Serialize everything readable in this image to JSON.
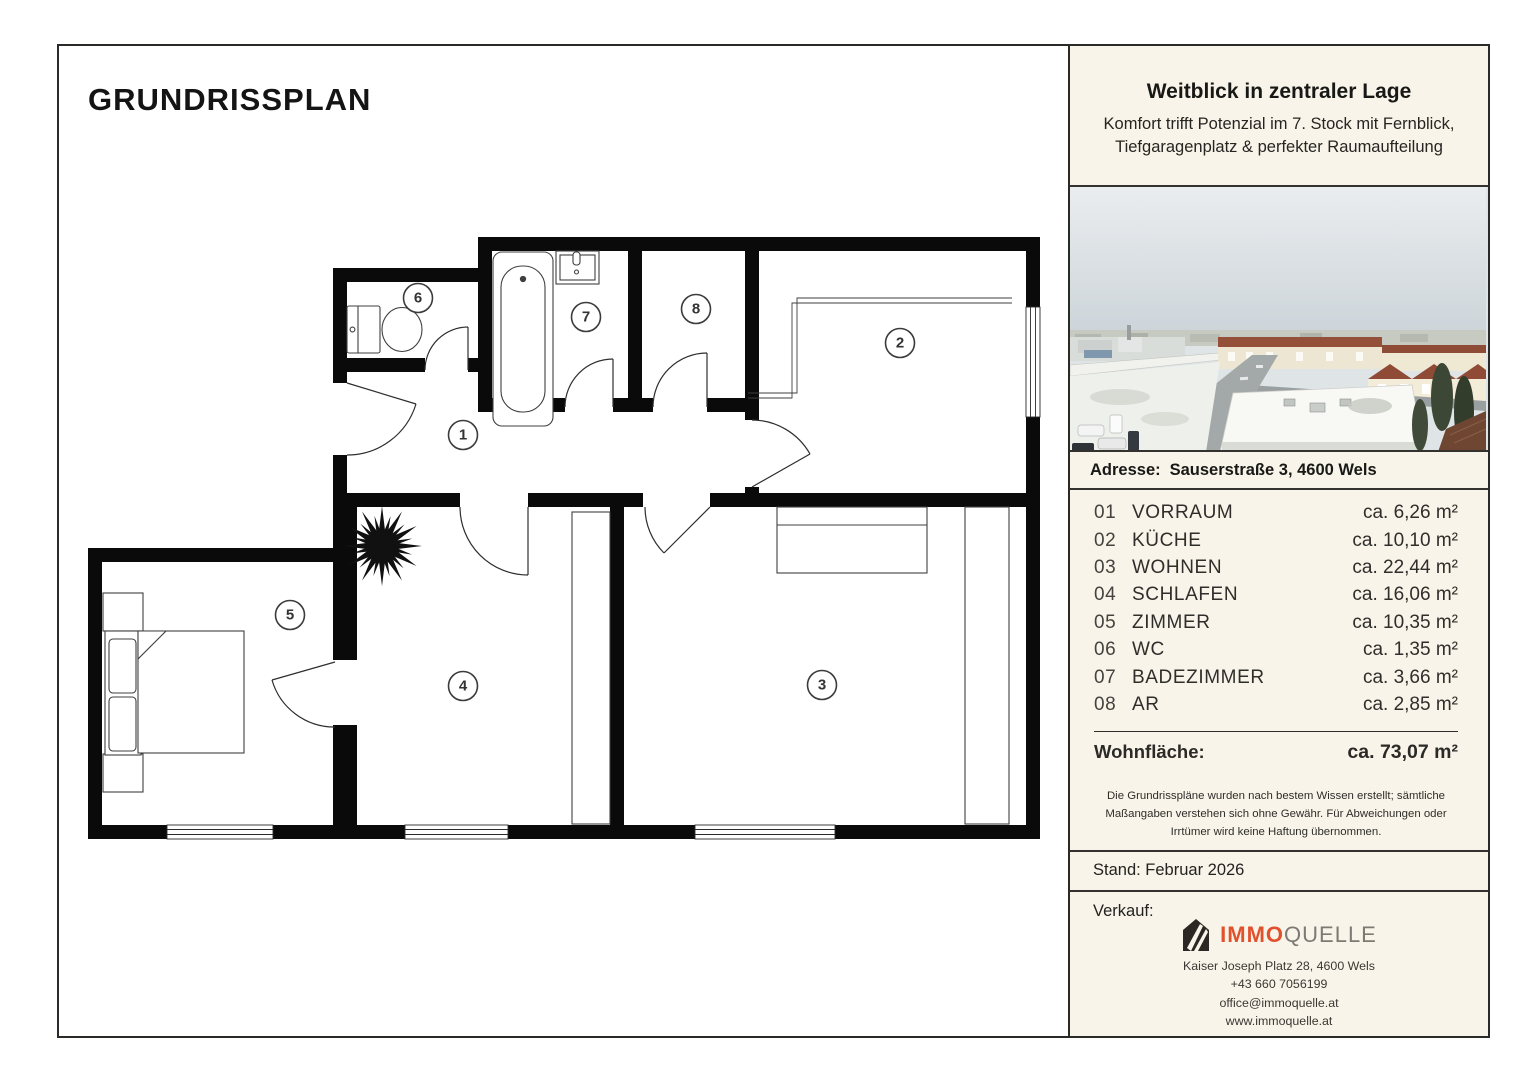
{
  "plan": {
    "title": "GRUNDRISSPLAN"
  },
  "panel": {
    "header": {
      "title": "Weitblick in zentraler Lage",
      "subtitle_line1": "Komfort trifft Potenzial im 7. Stock mit Fernblick,",
      "subtitle_line2": "Tiefgaragenplatz & perfekter Raumaufteilung"
    },
    "address": {
      "label": "Adresse:",
      "value": "Sauserstraße 3, 4600 Wels"
    },
    "rooms": [
      {
        "no": "01",
        "name": "VORRAUM",
        "area": "ca. 6,26 m²",
        "marker": "1"
      },
      {
        "no": "02",
        "name": "KÜCHE",
        "area": "ca. 10,10 m²",
        "marker": "2"
      },
      {
        "no": "03",
        "name": "WOHNEN",
        "area": "ca. 22,44 m²",
        "marker": "3"
      },
      {
        "no": "04",
        "name": "SCHLAFEN",
        "area": "ca. 16,06 m²",
        "marker": "4"
      },
      {
        "no": "05",
        "name": "ZIMMER",
        "area": "ca. 10,35 m²",
        "marker": "5"
      },
      {
        "no": "06",
        "name": "WC",
        "area": "ca. 1,35 m²",
        "marker": "6"
      },
      {
        "no": "07",
        "name": "BADEZIMMER",
        "area": "ca. 3,66 m²",
        "marker": "7"
      },
      {
        "no": "08",
        "name": "AR",
        "area": "ca. 2,85 m²",
        "marker": "8"
      }
    ],
    "total": {
      "label": "Wohnfläche:",
      "value": "ca. 73,07 m²"
    },
    "disclaimer": "Die Grundrisspläne wurden nach bestem Wissen erstellt; sämtliche Maßangaben verstehen sich ohne Gewähr. Für Abweichungen oder Irrtümer wird keine Haftung übernommen.",
    "stand": "Stand: Februar 2026",
    "sale": {
      "label": "Verkauf:",
      "logo_immo": "IMMO",
      "logo_quelle": "QUELLE",
      "address": "Kaiser Joseph Platz 28, 4600 Wels",
      "phone": "+43 660 7056199",
      "email": "office@immoquelle.at",
      "web": "www.immoquelle.at"
    },
    "colors": {
      "accent": "#E2512E",
      "cream": "#F8F4E9",
      "wall": "#0A0A0A"
    }
  }
}
